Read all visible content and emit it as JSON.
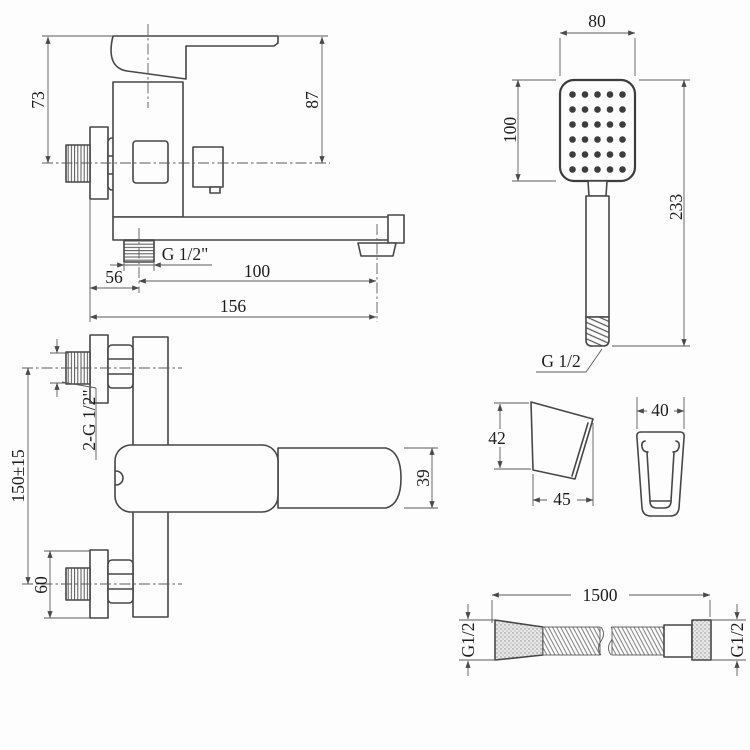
{
  "drawing": {
    "background": "#fdfdfd",
    "line_color": "#474747",
    "text_color": "#1c1c1c"
  },
  "faucet_side_view": {
    "dim_height_body": "73",
    "dim_height_handle": "87",
    "label_outlet_thread": "G 1/2\"",
    "dim_wall_to_outlet": "56",
    "dim_outlet_to_spout": "100",
    "dim_total_reach": "156"
  },
  "hand_shower_view": {
    "dim_head_width": "80",
    "dim_head_height": "100",
    "dim_total_length": "233",
    "label_thread": "G 1/2",
    "spray": {
      "rows": 6,
      "cols": 5
    }
  },
  "faucet_top_view": {
    "label_inlet_threads": "2-G 1/2\"",
    "dim_inlet_spacing": "150±15",
    "dim_flange": "60",
    "dim_spout_width": "39"
  },
  "bracket_side_view": {
    "dim_height": "42",
    "dim_depth": "45"
  },
  "bracket_front_view": {
    "dim_width": "40"
  },
  "hose_view": {
    "dim_length": "1500",
    "label_thread_left": "G1/2",
    "label_thread_right": "G1/2"
  }
}
